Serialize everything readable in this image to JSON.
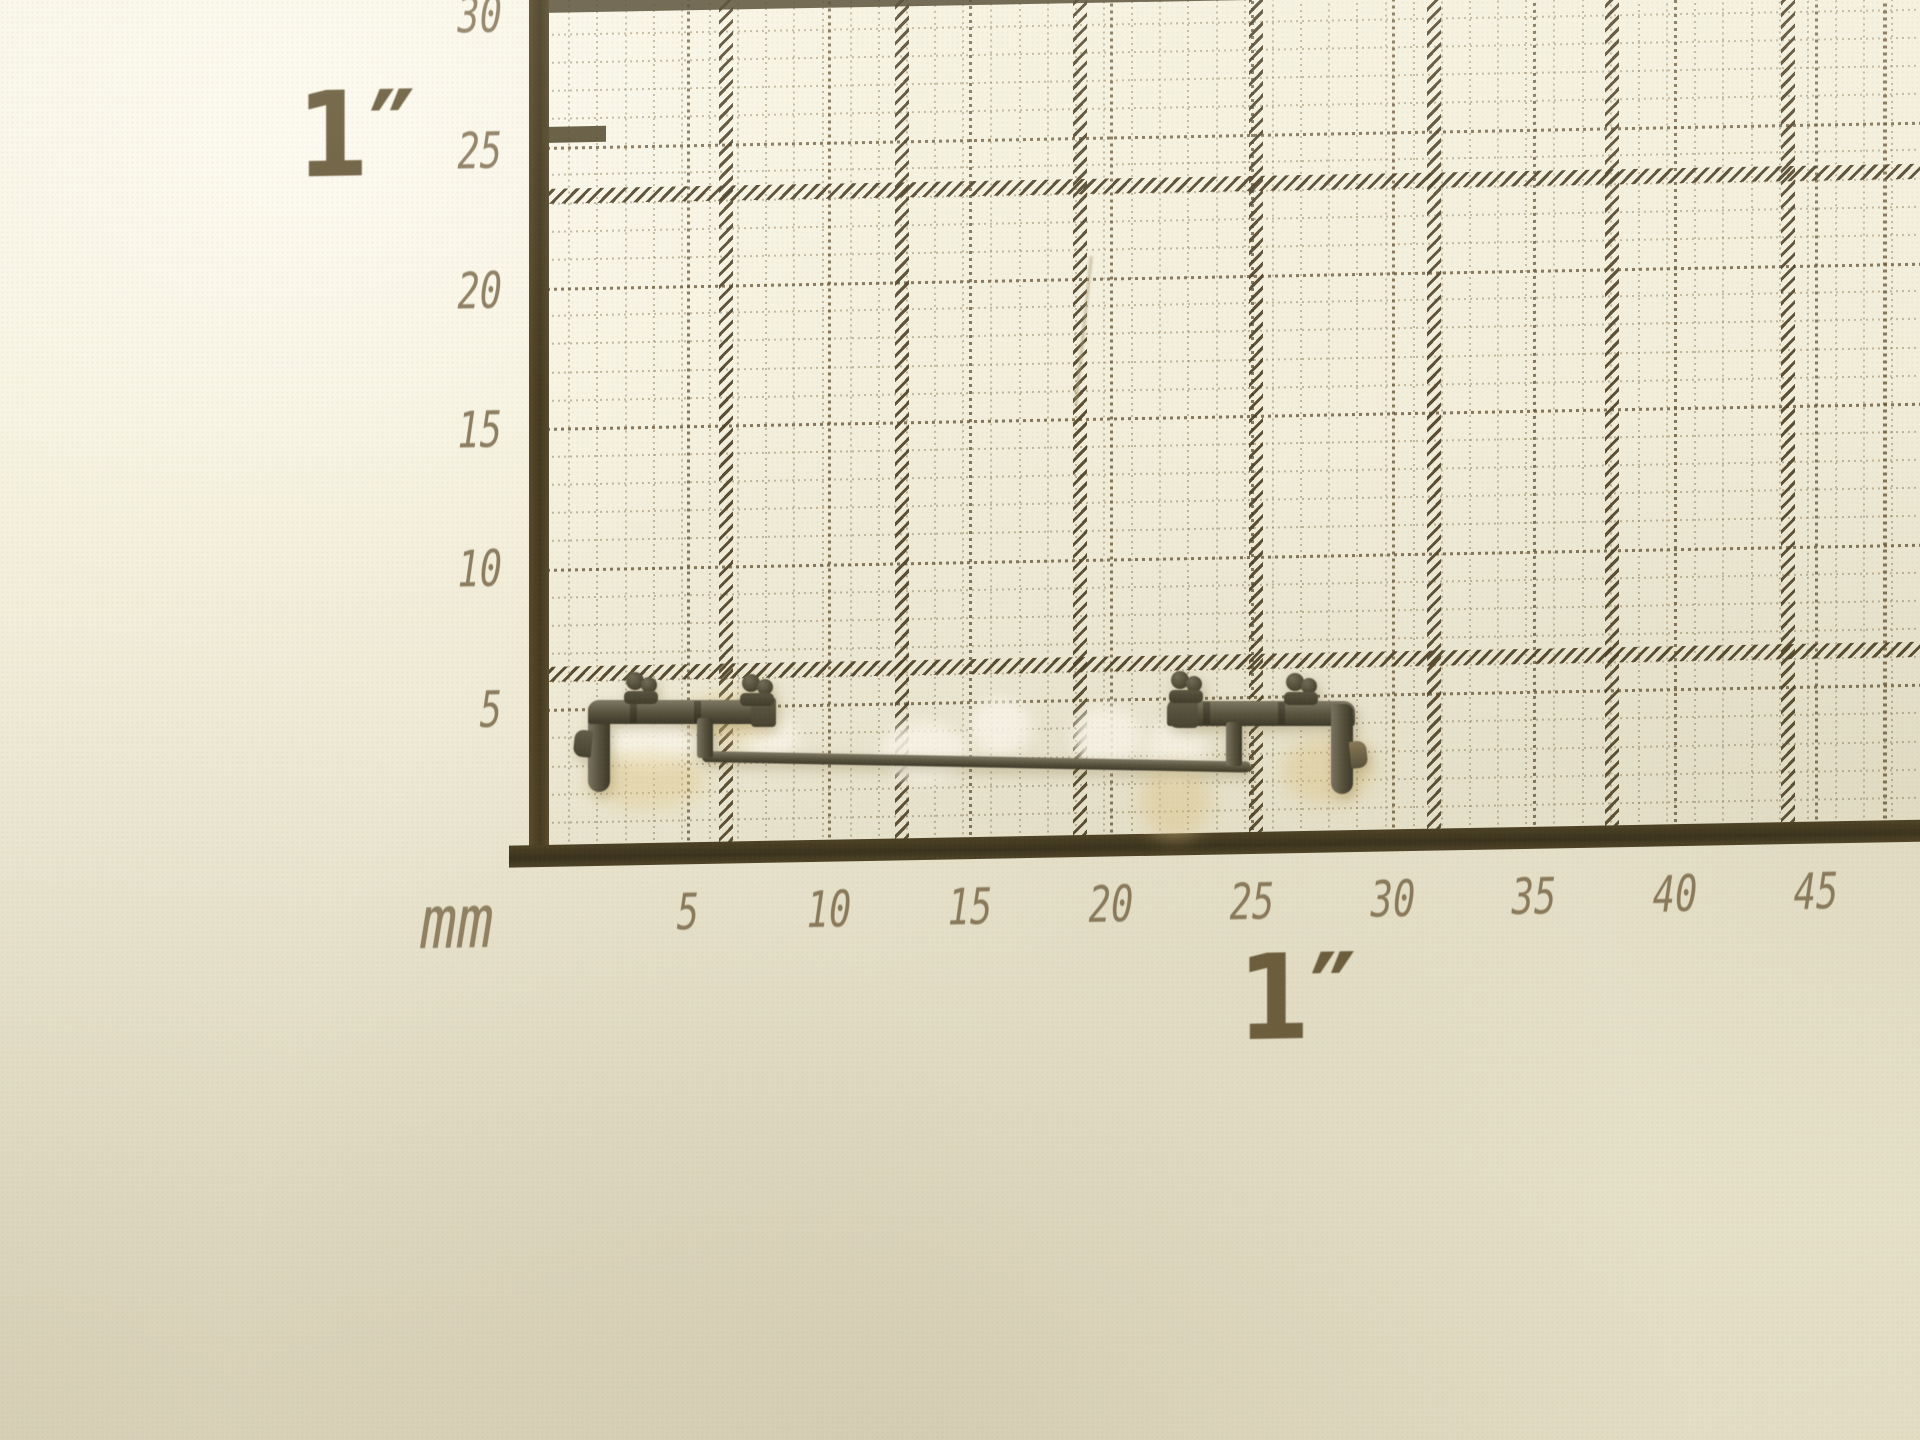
{
  "image_type": "photograph",
  "subject": {
    "object_label": "dark olive plastic handrail part with stanchion knobs",
    "surface_label": "cream millimeter graph paper with inch hatch lines"
  },
  "ruler": {
    "unit_label": "mm",
    "left_inch_label": "1″",
    "bottom_inch_label": "1″",
    "x_ticks": [
      "5",
      "10",
      "15",
      "20",
      "25",
      "30",
      "35",
      "40",
      "45"
    ],
    "y_ticks": [
      "30",
      "25",
      "20",
      "15",
      "10",
      "5"
    ]
  },
  "colors": {
    "paper": "#f3efda",
    "grid_minor": "#978868",
    "grid_medium": "#68583a",
    "grid_heavy": "#3b3420",
    "print_label": "#7a694a",
    "part_base": "#56523e",
    "part_dark": "#3b382a",
    "part_light": "#7b7663"
  }
}
